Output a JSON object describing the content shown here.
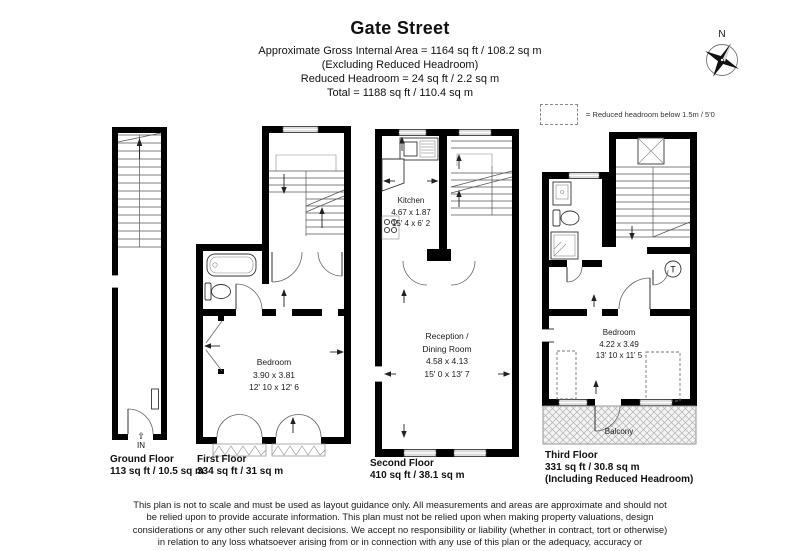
{
  "header": {
    "title": "Gate Street",
    "lines": [
      "Approximate Gross Internal Area = 1164 sq ft / 108.2 sq m",
      "(Excluding Reduced Headroom)",
      "Reduced Headroom = 24 sq ft / 2.2 sq m",
      "Total = 1188 sq ft / 110.4 sq m"
    ]
  },
  "compass": {
    "label": "N"
  },
  "legend": {
    "text": "= Reduced headroom below 1.5m / 5'0"
  },
  "floors": {
    "ground": {
      "name": "Ground Floor",
      "area": "113 sq ft / 10.5 sq m",
      "entrance": "IN"
    },
    "first": {
      "name": "First Floor",
      "area": "334 sq ft / 31 sq m",
      "bedroom": {
        "label": "Bedroom",
        "metric": "3.90 x 3.81",
        "imperial": "12' 10 x 12' 6"
      }
    },
    "second": {
      "name": "Second Floor",
      "area": "410 sq ft / 38.1 sq m",
      "kitchen": {
        "label": "Kitchen",
        "metric": "4.67 x 1.87",
        "imperial": "15' 4 x 6' 2"
      },
      "reception": {
        "label1": "Reception /",
        "label2": "Dining Room",
        "metric": "4.58 x 4.13",
        "imperial": "15' 0 x 13' 7"
      }
    },
    "third": {
      "name": "Third Floor",
      "area": "331 sq ft / 30.8 sq m",
      "area_note": "(Including Reduced Headroom)",
      "bedroom": {
        "label": "Bedroom",
        "metric": "4.22 x 3.49",
        "imperial": "13' 10 x 11' 5"
      },
      "balcony": "Balcony",
      "tank": "T"
    }
  },
  "disclaimer": "This plan is not to scale and must be used as layout guidance only. All measurements and areas are approximate and should not be relied upon to provide accurate information. This plan must not be relied upon when making property valuations, design considerations or any other such relevant decisions. We accept no responsibility or liability (whether in contract, tort or otherwise) in relation to any loss whatsoever arising from or in connection with any use of this plan or the adequacy, accuracy or completeness of it or any information within it."
}
